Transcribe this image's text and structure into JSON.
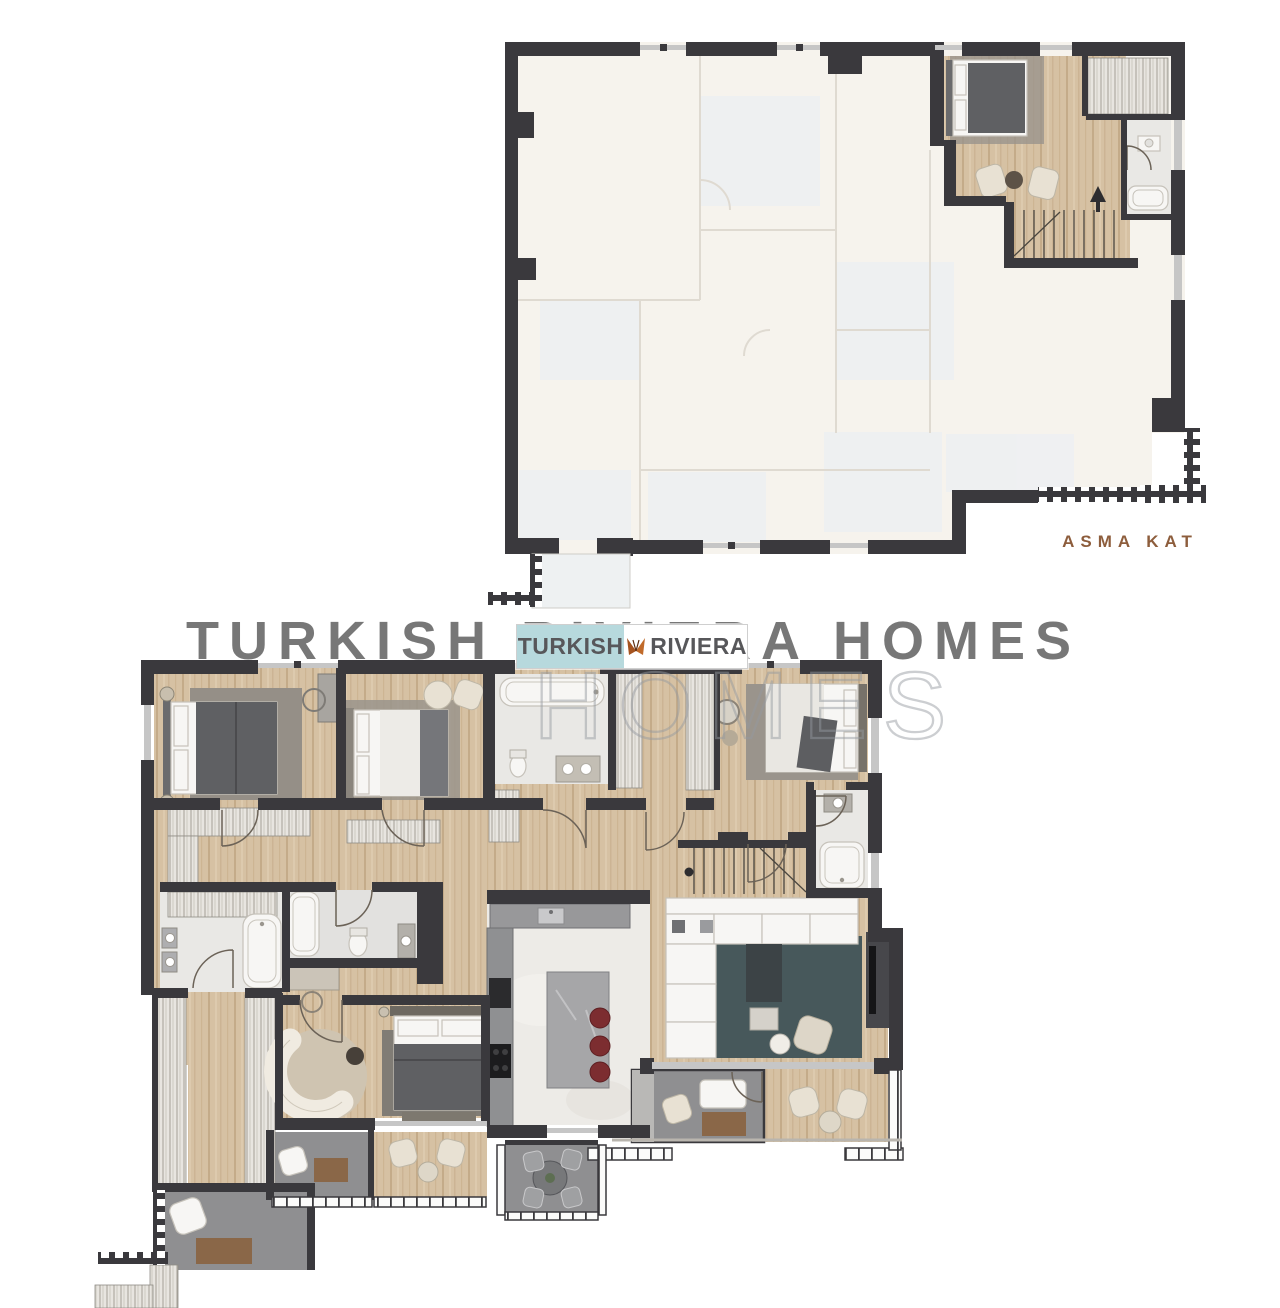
{
  "plans": {
    "upper": {
      "label": "ASMA KAT"
    },
    "lower": {
      "label": ""
    }
  },
  "branding": {
    "logo": {
      "left_text": "TURKISH",
      "right_text": "RIVIERA",
      "left_bg": "#b7d9dd",
      "right_bg": "#ffffff",
      "text_color": "#57575a",
      "butterfly_color": "#b8622c"
    },
    "watermark_homes": "HOMES",
    "watermark_line": "TURKISH RIVIERA HOMES"
  },
  "theme": {
    "wall": "#3a393d",
    "window-line": "#c6c6c6",
    "wood": "#d6c1a3",
    "wood-dark": "#c4ab89",
    "ghost-floor": "#f6f3ed",
    "ghost-room": "#eef0f2",
    "tile": "#e9e8e5",
    "marble": "#edebe7",
    "balcony": "#8f8f91",
    "rug-living": "#47585b",
    "rug-gray": "#9a948c",
    "duvet": "#5f6063",
    "white-fixture": "#f7f6f4",
    "closet-bg": "#e8e5e0",
    "closet-line": "#a39f96",
    "red-stool": "#7c2d30",
    "table-brown": "#8a6748",
    "cream": "#e8e1d3",
    "accent-text": "#8d5d3c",
    "arc": "#6b6257"
  }
}
